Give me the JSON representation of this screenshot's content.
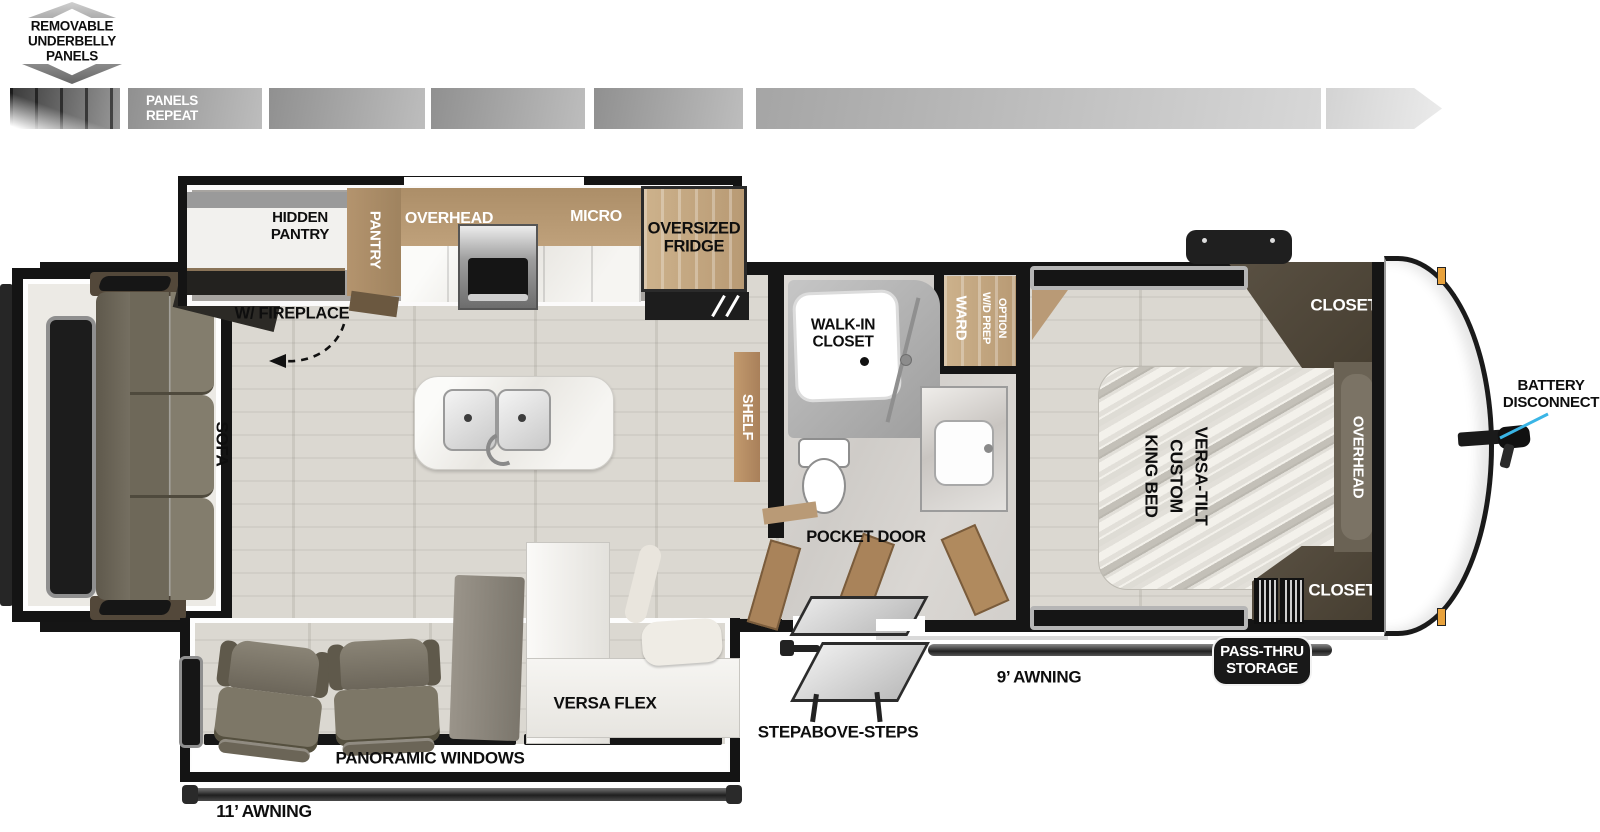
{
  "underbelly": {
    "label": "REMOVABLE\nUNDERBELLY\nPANELS",
    "repeat_label": "PANELS\nREPEAT"
  },
  "kitchen": {
    "hidden_pantry": "HIDDEN\nPANTRY",
    "pantry": "PANTRY",
    "overhead": "OVERHEAD",
    "micro": "MICRO",
    "fridge": "OVERSIZED\nFRIDGE",
    "ent_center": "ENT. CENTER\nW/ FIREPLACE",
    "shelf": "SHELF"
  },
  "living": {
    "sofa": "SOFA",
    "versa_flex": "VERSA FLEX"
  },
  "bathroom": {
    "walk_in_closet": "WALK-IN\nCLOSET",
    "ward": "WARD",
    "wd_prep": "W/D PREP",
    "option": "OPTION",
    "pocket_door": "POCKET DOOR"
  },
  "bedroom": {
    "bed": "VERSA-TILT\nCUSTOM\nKING BED",
    "closet_top": "CLOSET",
    "closet_bottom": "CLOSET",
    "overhead": "OVERHEAD"
  },
  "exterior": {
    "battery": "BATTERY\nDISCONNECT",
    "pass_thru": "PASS-THRU\nSTORAGE",
    "awning_door_side": "9’ AWNING",
    "awning_camp_side": "11’ AWNING",
    "steps": "STEPABOVE-STEPS",
    "panoramic_windows": "PANORAMIC WINDOWS"
  },
  "colors": {
    "callout_line": "#3ab5e6",
    "wall": "#151515",
    "cabinet_wood": "#b2946f",
    "dark_wood": "#4e4434",
    "upholstery": "#7b7567"
  }
}
